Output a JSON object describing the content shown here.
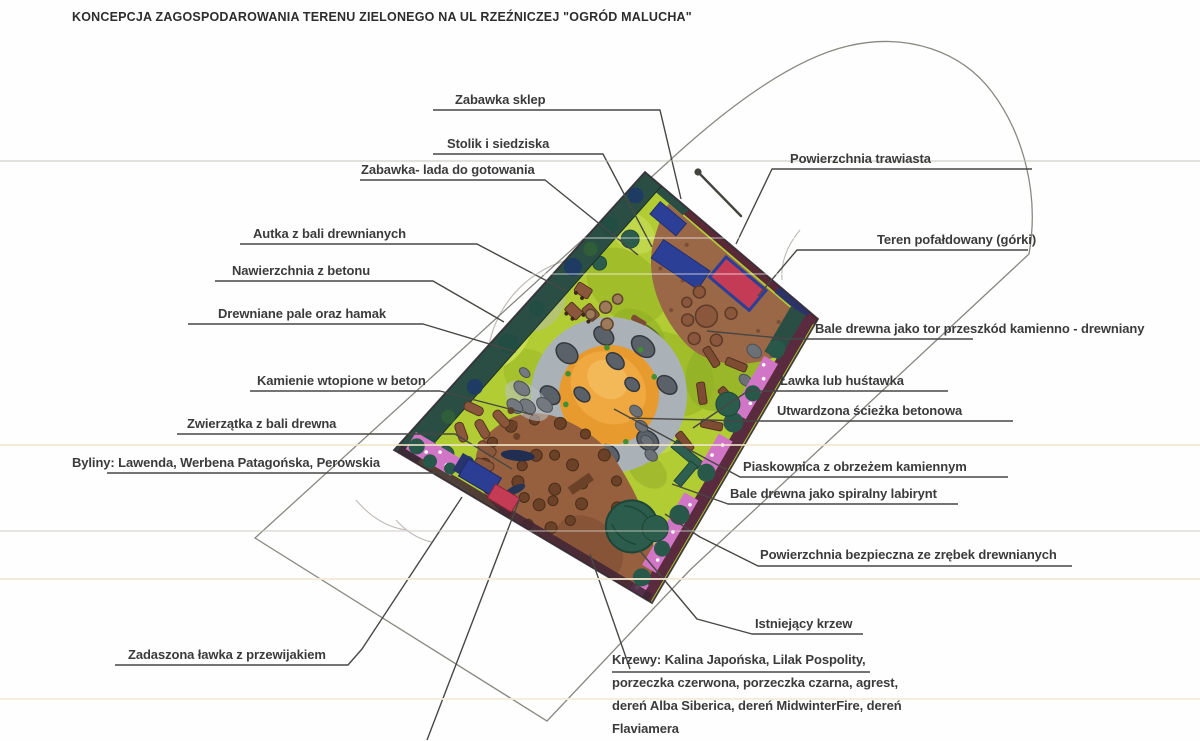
{
  "title": "KONCEPCJA ZAGOSPODAROWANIA TERENU ZIELONEGO NA UL RZEŹNICZEJ \"OGRÓD MALUCHA\"",
  "labels": {
    "zabawka_sklep": {
      "text": "Zabawka sklep"
    },
    "stolik_siedziska": {
      "text": "Stolik i siedziska"
    },
    "zabawka_lada": {
      "text": "Zabawka- lada do gotowania"
    },
    "autka": {
      "text": "Autka z bali drewnianych"
    },
    "nawierzchnia_betonu": {
      "text": "Nawierzchnia z betonu"
    },
    "drewniane_pale": {
      "text": "Drewniane pale oraz hamak"
    },
    "kamienie": {
      "text": "Kamienie wtopione w beton"
    },
    "zwierzatka": {
      "text": "Zwierzątka z bali drewna"
    },
    "byliny": {
      "text": "Byliny: Lawenda, Werbena Patagońska, Perowskia"
    },
    "zadaszona_lawka": {
      "text": "Zadaszona ławka z przewijakiem"
    },
    "powierzchnia_trawiasta": {
      "text": "Powierzchnia trawiasta"
    },
    "teren_pofaldowany": {
      "text": "Teren pofałdowany (górki)"
    },
    "bale_tor": {
      "text": "Bale drewna jako tor przeszkód kamienno - drewniany"
    },
    "lawka_hustawka": {
      "text": "Ławka lub huśtawka"
    },
    "utwardzona_sciezka": {
      "text": "Utwardzona ścieżka betonowa"
    },
    "piaskownica": {
      "text": "Piaskownica z obrzeżem kamiennym"
    },
    "bale_labirynt": {
      "text": "Bale drewna jako spiralny labirynt"
    },
    "powierzchnia_bezpieczna": {
      "text": "Powierzchnia bezpieczna ze zrębek drewnianych"
    },
    "istniejacy_krzew": {
      "text": "Istniejący krzew"
    },
    "krzewy": {
      "lines": [
        "Krzewy: Kalina Japońska, Lilak Pospolity,",
        "porzeczka czerwona, porzeczka czarna, agrest,",
        "dereń Alba Siberica, dereń MidwinterFire, dereń",
        "Flaviamera"
      ]
    }
  },
  "palette": {
    "grass": "#b2cc33",
    "woodchips": "#9a6747",
    "sand": "#e79a2e",
    "concrete_ring": "#aab1b7",
    "hedge": "#2b4e44",
    "border_maroon": "#5a2a3e",
    "flowers_pink": "#d176c6",
    "equipment_blue": "#2c3f96",
    "equipment_red": "#c43b55",
    "shrub_green": "#2c5c4c",
    "label_ink": "#3b3b3b"
  }
}
